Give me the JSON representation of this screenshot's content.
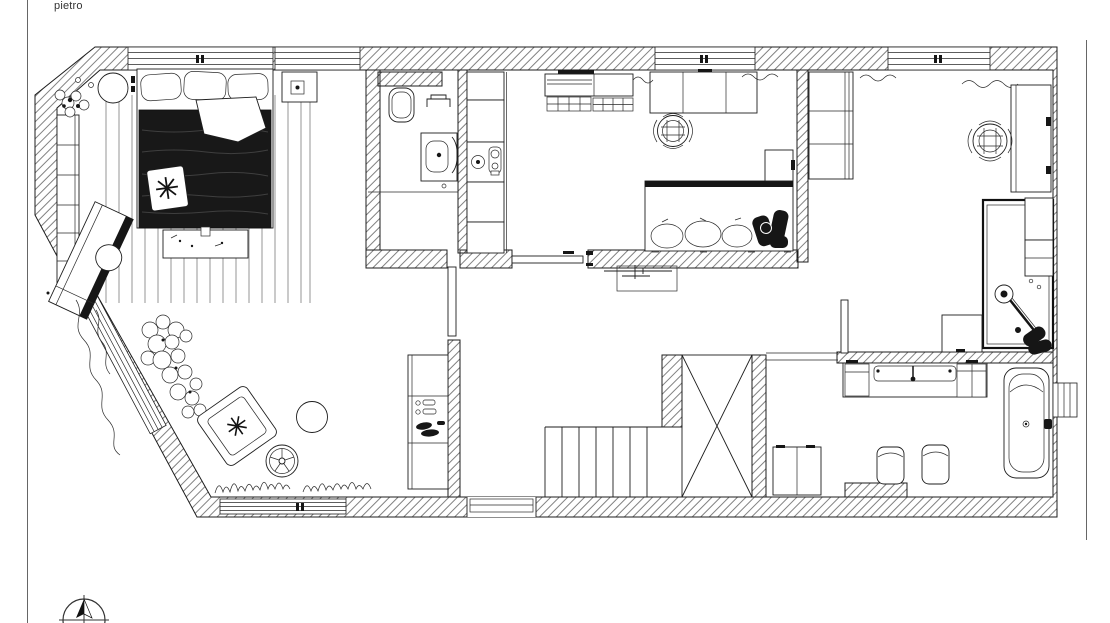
{
  "sheet": {
    "annotation": "pietro",
    "background": "#ffffff",
    "ink": "#1d1d1d",
    "dark_fill": "#161616"
  },
  "plan": {
    "kind": "residential floor plan, top view, hatched masonry walls",
    "north_arrow": "compass-north-arrow",
    "rooms_labeled": false
  },
  "symbols": {
    "bedroom": [
      "double-bed",
      "pillows",
      "dark-duvet",
      "throw-blanket",
      "star-cushion",
      "foot-bench",
      "striped-area-rug",
      "round-side-table",
      "potted-plant",
      "closet-column",
      "nightstand-with-lamp",
      "chaise-longue"
    ],
    "winter_garden": [
      "flower-shrubs",
      "climbing-vine",
      "lounge-armchair-with-star-cushion",
      "round-table",
      "spoke-wheel-table",
      "grass-tufts"
    ],
    "bathroom_1": [
      "toilet",
      "towel-rail",
      "washbasin-vanity",
      "floor-divider",
      "open-door-leaf"
    ],
    "utility_column": [
      "tall-cabinet-stack",
      "appliance-niche-fixtures"
    ],
    "living_room": [
      "kitchen-counter-with-basket-drawers",
      "dining-table",
      "rattan-chair",
      "corner-sofa-with-cushions",
      "side-table",
      "sliding-door",
      "console-table",
      "curtains"
    ],
    "study_room": [
      "wardrobe",
      "desk",
      "rattan-armchair",
      "single-bed",
      "overbed-shelving",
      "guitar",
      "side-cabinet",
      "curtains"
    ],
    "hall": [
      "shoe-cabinet-with-shoes",
      "staircase-straight-run",
      "staircase-winders",
      "entry-threshold"
    ],
    "bathroom_2": [
      "vanity-with-basin",
      "faucet",
      "two-stools",
      "storage-cabinet",
      "bathtub",
      "side-window"
    ]
  }
}
